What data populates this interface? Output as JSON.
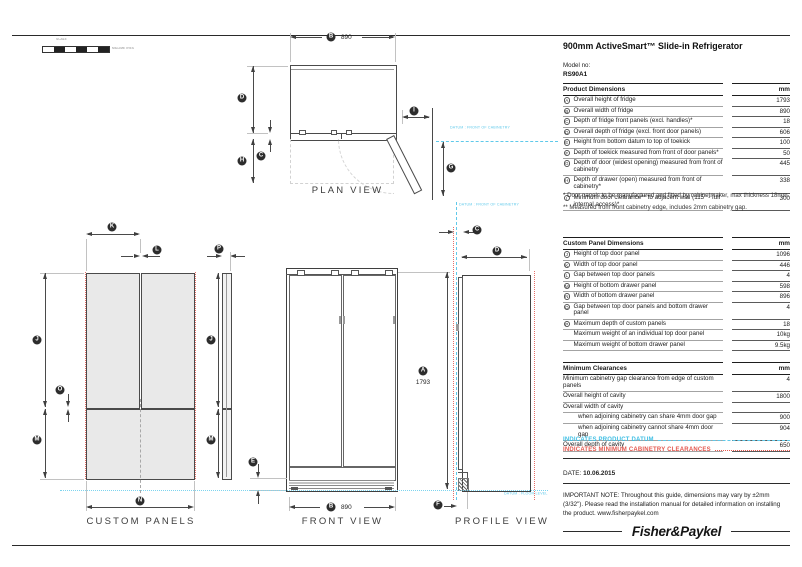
{
  "page": {
    "title": "900mm ActiveSmart™ Slide-in Refrigerator",
    "model_label": "Model no:",
    "model_no": "RS90A1",
    "date_label": "DATE:",
    "date": "10.06.2015",
    "important_note": "IMPORTANT NOTE: Throughout this guide, dimensions may vary by ±2mm (3/32\"). Please read the installation manual for detailed information on installing the product. www.fisherpaykel.com",
    "brand": "Fisher&Paykel"
  },
  "scale_bar": {
    "label": "SCALE",
    "units": "MILLIMETRES"
  },
  "colors": {
    "datum": "#5fc9ea",
    "clearance": "#e4574e",
    "panel_fill": "#e9e9e9"
  },
  "product_dimensions": {
    "title": "Product Dimensions",
    "unit": "mm",
    "rows": [
      {
        "letter": "A",
        "desc": "Overall height of fridge",
        "value": "1793"
      },
      {
        "letter": "B",
        "desc": "Overall width of fridge",
        "value": "890"
      },
      {
        "letter": "C",
        "desc": "Depth of fridge front panels (excl. handles)*",
        "value": "18"
      },
      {
        "letter": "D",
        "desc": "Overall depth of fridge (excl. front door panels)",
        "value": "606"
      },
      {
        "letter": "E",
        "desc": "Height from bottom datum to top of toekick",
        "value": "100"
      },
      {
        "letter": "F",
        "desc": "Depth of toekick measured from front of door panels*",
        "value": "50"
      },
      {
        "letter": "G",
        "desc": "Depth of door (widest opening) measured from front of cabinetry",
        "value": "445"
      },
      {
        "letter": "H",
        "desc": "Depth of drawer (open) measured from front of cabinetry*",
        "value": "338"
      },
      {
        "letter": "I",
        "desc": "Minimum door clearance** to adjacent wall (115° - full internal access)*",
        "value": "300"
      }
    ],
    "footnotes": [
      "* Door panels to be manufactured and fitted by cabinetmaker, max thickness 18mm.",
      "** Measured from front cabinetry edge, includes 2mm cabinetry gap."
    ]
  },
  "custom_panel_dimensions": {
    "title": "Custom Panel Dimensions",
    "unit": "mm",
    "rows": [
      {
        "letter": "J",
        "desc": "Height of top door panel",
        "value": "1096"
      },
      {
        "letter": "K",
        "desc": "Width of top door panel",
        "value": "446"
      },
      {
        "letter": "L",
        "desc": "Gap between top door panels",
        "value": "4"
      },
      {
        "letter": "M",
        "desc": "Height of bottom drawer panel",
        "value": "598"
      },
      {
        "letter": "N",
        "desc": "Width of bottom drawer panel",
        "value": "896"
      },
      {
        "letter": "O",
        "desc": "Gap between top door panels and bottom drawer panel",
        "value": "4"
      },
      {
        "letter": "P",
        "desc": "Maximum depth of custom panels",
        "value": "18"
      },
      {
        "letter": "",
        "desc": "Maximum weight of an individual top door panel",
        "value": "10kg"
      },
      {
        "letter": "",
        "desc": "Maximum weight of bottom drawer panel",
        "value": "9.5kg"
      }
    ]
  },
  "minimum_clearances": {
    "title": "Minimum Clearances",
    "unit": "mm",
    "rows": [
      {
        "desc": "Minimum cabinetry gap clearance from edge of custom panels",
        "value": "4",
        "indent": false
      },
      {
        "desc": "Overall height of cavity",
        "value": "1800",
        "indent": false
      },
      {
        "desc": "Overall width of cavity",
        "value": "",
        "indent": false
      },
      {
        "desc": "when adjoining cabinetry can share 4mm door gap",
        "value": "900",
        "indent": true
      },
      {
        "desc": "when adjoining cabinetry cannot share 4mm door gap",
        "value": "904",
        "indent": true
      },
      {
        "desc": "Overall depth of cavity",
        "value": "650",
        "indent": false
      }
    ]
  },
  "legend": {
    "datum": "INDICATES PRODUCT DATUM",
    "clearances": "INDICATES MINIMUM CABINETRY CLEARANCES"
  },
  "diagrams": {
    "plan": {
      "label": "PLAN VIEW",
      "width_value": "890"
    },
    "custom_panels": {
      "label": "CUSTOM PANELS"
    },
    "front": {
      "label": "FRONT VIEW",
      "width_value": "890",
      "height_value": "1793"
    },
    "profile": {
      "label": "PROFILE VIEW"
    },
    "datum_front_label": "DATUM : FRONT OF CABINETRY",
    "datum_floor_label": "DATUM : FLOOR LEVEL",
    "letters": {
      "a": "A",
      "b": "B",
      "c": "C",
      "d": "D",
      "e": "E",
      "f": "F",
      "g": "G",
      "h": "H",
      "i": "I",
      "j": "J",
      "k": "K",
      "l": "L",
      "m": "M",
      "n": "N",
      "o": "O",
      "p": "P"
    }
  }
}
